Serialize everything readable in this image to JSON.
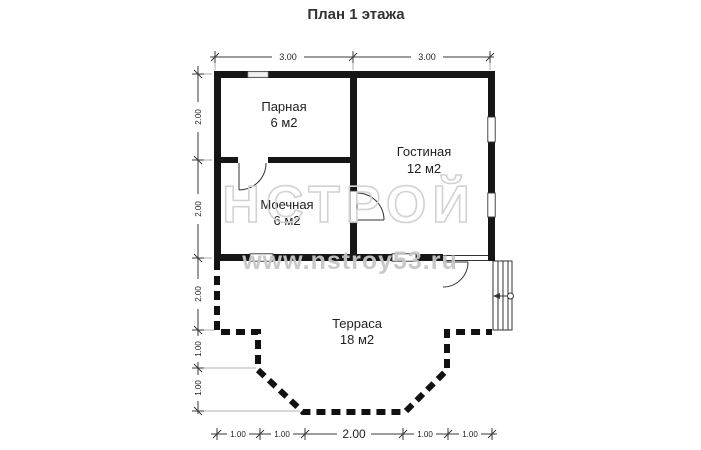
{
  "title": "План 1 этажа",
  "rooms": [
    {
      "name": "Парная",
      "area": "6 м2"
    },
    {
      "name": "Гостиная",
      "area": "12 м2"
    },
    {
      "name": "Моечная",
      "area": "6 м2"
    },
    {
      "name": "Терраса",
      "area": "18 м2"
    }
  ],
  "dimensions": {
    "top": [
      "3.00",
      "3.00"
    ],
    "left": [
      "2.00",
      "2.00",
      "2.00",
      "1.00",
      "1.00"
    ],
    "bottom": [
      "1.00",
      "1.00",
      "2.00",
      "1.00",
      "1.00"
    ]
  },
  "watermark": {
    "logo": "НСТРОЙ",
    "url": "www.nstroy53.ru"
  },
  "symbols": [
    "door-swing",
    "window",
    "stairs",
    "entrance-arrow"
  ],
  "colors": {
    "wall": "#161616",
    "line": "#333333",
    "extension": "#9a9a9a",
    "watermark": "#c9c9c9",
    "background": "#ffffff"
  }
}
